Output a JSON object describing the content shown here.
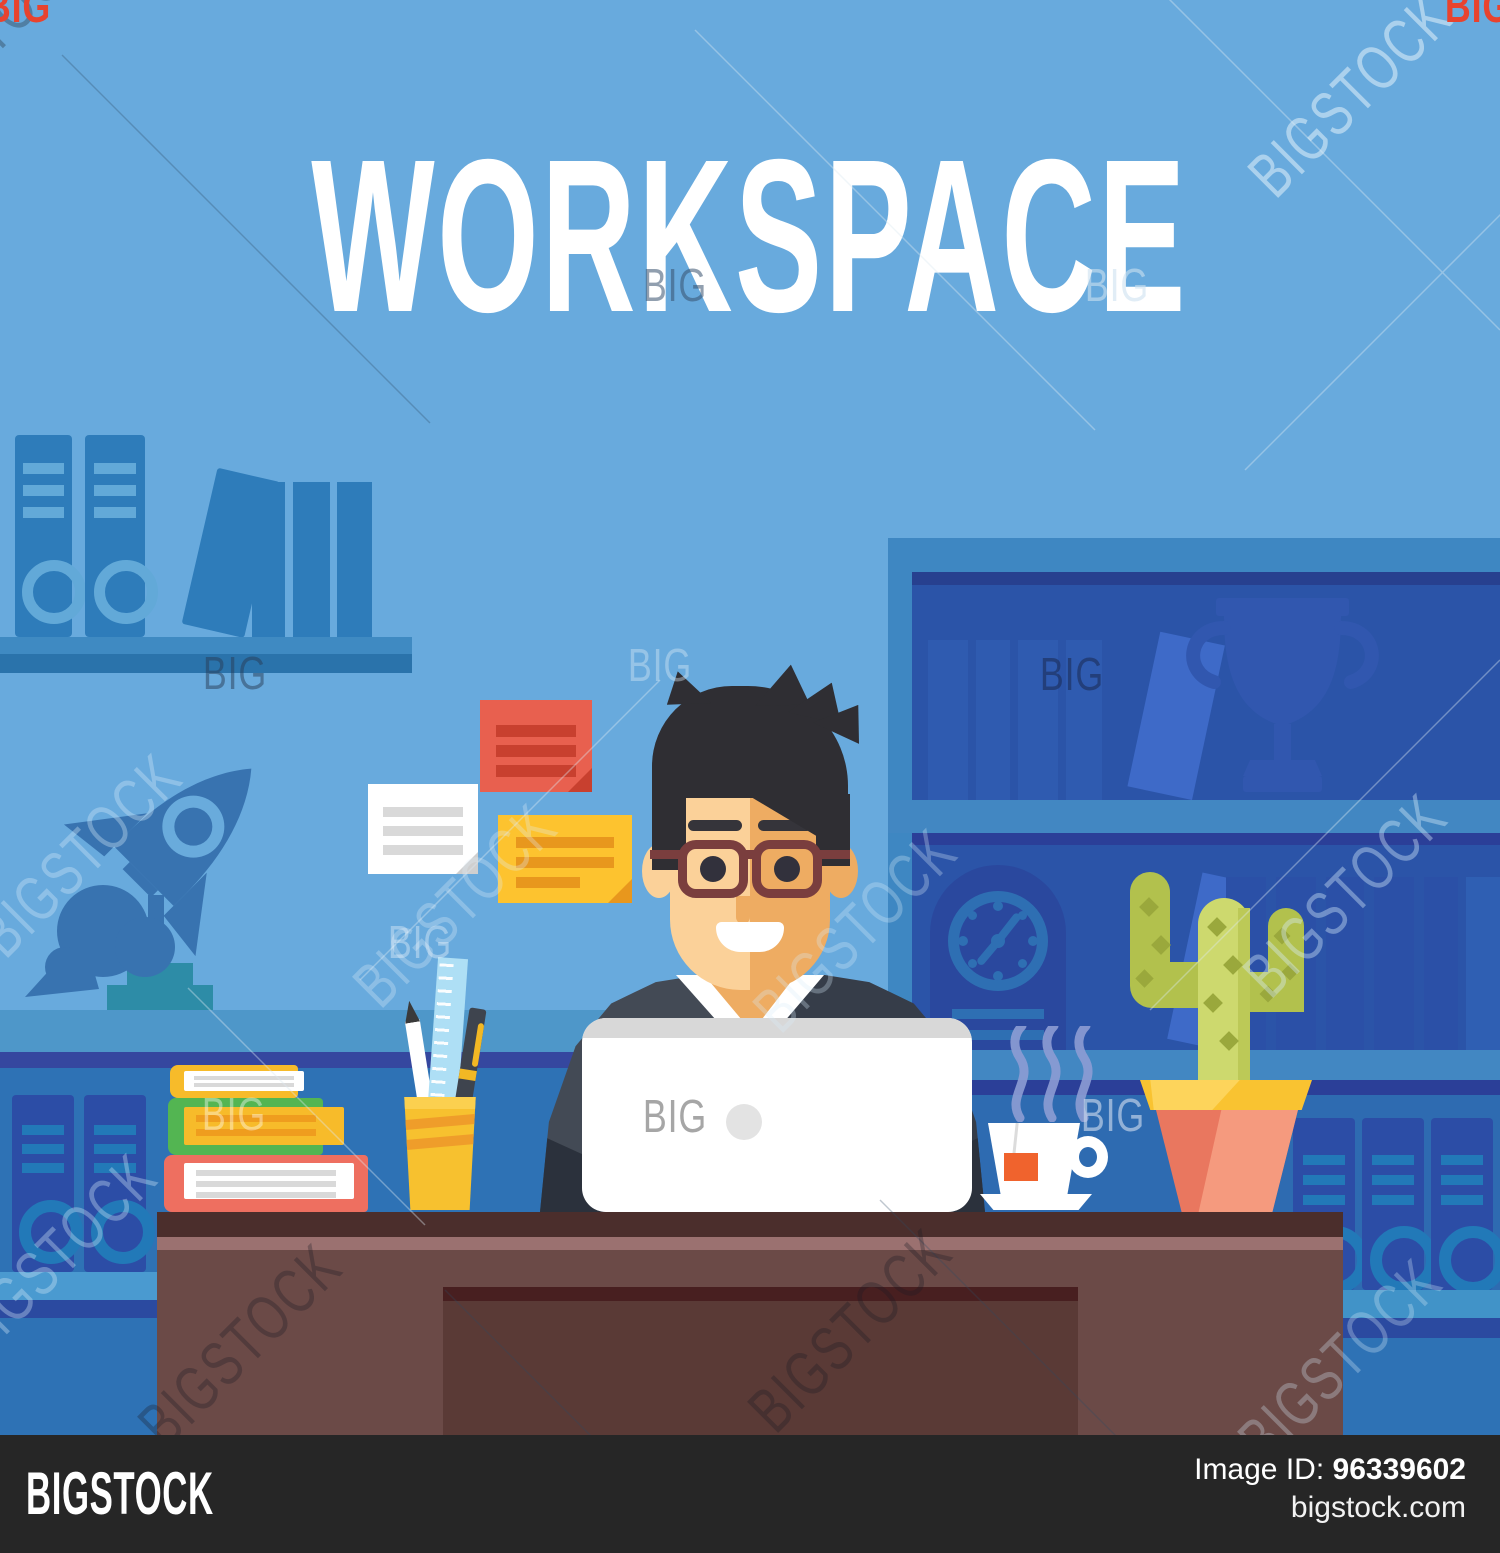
{
  "title": "WORKSPACE",
  "watermark": {
    "brand": "BIGSTOCK",
    "small": "BIG"
  },
  "footer": {
    "brand": "BIGSTOCK",
    "image_id_label": "Image ID:",
    "image_id": "96339602",
    "site": "bigstock.com"
  },
  "palette": {
    "wall": "#68AADD",
    "band_light": "#4E97C9",
    "band_navy": "#35479F",
    "lower_wall": "#2E72B5",
    "shelf_blue": "#2E7CBA",
    "shelf_detail": "#62A9D8",
    "bookcase_frame": "#3E87C2",
    "bookcase_interior": "#2B54A8",
    "book_dark": "#2F5BB0",
    "book_light": "#3E6AC8",
    "trophy": "#3157AF",
    "clock_body": "#2A489E",
    "binder": "#2C4DA6",
    "binder_detail": "#2279B8",
    "rocket": "#3873B0",
    "rocket_base": "#2D8CA7",
    "note_red": "#E8604F",
    "note_yellow": "#FDC32F",
    "note_white": "#FFFFFF",
    "skin_light": "#FBD199",
    "skin_dark": "#EEAC62",
    "hair": "#2F2E33",
    "glasses": "#7A3E3E",
    "suit_light": "#434A55",
    "suit_dark": "#363D49",
    "laptop": "#FFFFFF",
    "desk_top": "#4B2E2C",
    "desk_stripe": "#9B7170",
    "desk_body": "#6B4A47",
    "book_stack_yellow": "#F7BB2A",
    "book_stack_green": "#53B552",
    "book_stack_red": "#EE6F60",
    "pencil_cup": "#F7C12F",
    "ruler": "#AEDFF5",
    "cactus_light": "#CDD96E",
    "cactus_dark": "#B2C14D",
    "pot": "#E9775F",
    "pot_rim": "#F9C331",
    "tea_tag": "#F0632D",
    "steam": "#8D9DD4",
    "footer_bg": "#262626",
    "corner_mark": "#E8432E"
  }
}
